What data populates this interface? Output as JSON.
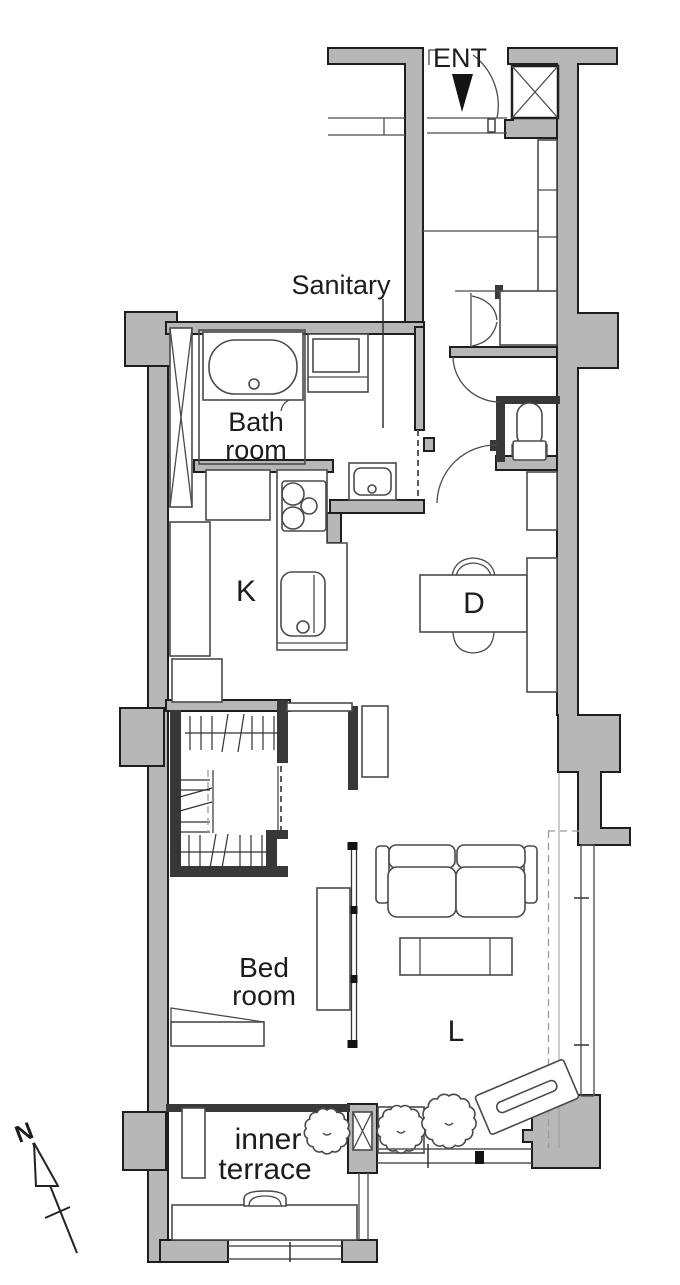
{
  "document": {
    "type": "apartment-floor-plan",
    "rooms": [
      "Entrance",
      "Sanitary",
      "Bath room",
      "Kitchen",
      "Dining",
      "Walk-in closet",
      "Bed room",
      "Living",
      "Inner terrace",
      "WC"
    ]
  },
  "labels": {
    "ent": "ENT",
    "sanitary": "Sanitary",
    "bath1": "Bath",
    "bath2": "room",
    "kitchen": "K",
    "dining": "D",
    "bed1": "Bed",
    "bed2": "room",
    "living": "L",
    "terrace1": "inner",
    "terrace2": "terrace",
    "north": "N"
  },
  "colors": {
    "bg": "#ffffff",
    "wall_fill": "#b7b7b7",
    "wall_stroke": "#1e1e1e",
    "dark_wall": "#383838",
    "line": "#4a4a4a",
    "text": "#1c1c1c"
  },
  "symbols": {
    "plants": [
      {
        "cx": 327,
        "cy": 1131,
        "r": 21
      },
      {
        "cx": 401,
        "cy": 1129,
        "r": 22
      },
      {
        "cx": 449,
        "cy": 1121,
        "r": 25
      }
    ]
  }
}
